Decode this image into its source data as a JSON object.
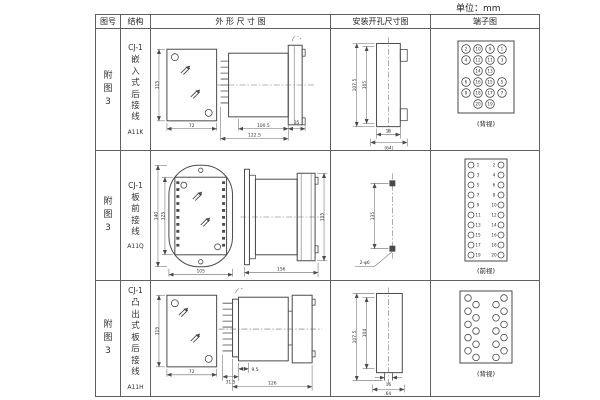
{
  "unit_label": "单位：mm",
  "colors": {
    "background": "#ffffff",
    "line": "#4a4a4a",
    "text": "#333333"
  },
  "header": {
    "figure": "图号",
    "structure": "结构",
    "outline": "外 形 尺 寸 图",
    "mounting": "安装开孔尺寸图",
    "terminal": "端子图"
  },
  "rows": [
    {
      "figure": "附图3",
      "model": "CJ-1",
      "structure": "嵌入式后接线",
      "code": "A11K",
      "outline": {
        "front_h": "115",
        "front_w": "72",
        "d1": "100.5",
        "d2": "122.5",
        "d3": "35"
      },
      "mounting": {
        "h1": "107.5",
        "h2": "105",
        "w1": "16",
        "w2": "(64)"
      },
      "terminal": {
        "view": "(背视)",
        "numbers": [
          [
            "2",
            "10",
            "9",
            "1"
          ],
          [
            "4",
            "12",
            "11",
            "3"
          ],
          [
            "14",
            "13"
          ],
          [
            "6",
            "16",
            "15",
            "5"
          ],
          [
            "8",
            "18",
            "17",
            "7"
          ],
          [
            "20",
            "19"
          ]
        ]
      }
    },
    {
      "figure": "附图3",
      "model": "CJ-1",
      "structure": "板前接线",
      "code": "A11Q",
      "outline": {
        "front_h1": "140",
        "front_h2": "125",
        "front_w": "105",
        "d1": "156",
        "d2": "115"
      },
      "mounting": {
        "h1": "135",
        "holes": "2-φ6"
      },
      "terminal": {
        "view": "(前视)",
        "left": [
          "1",
          "3",
          "5",
          "7",
          "9",
          "11",
          "13",
          "15",
          "17",
          "19"
        ],
        "right": [
          "2",
          "4",
          "6",
          "8",
          "10",
          "12",
          "14",
          "16",
          "18",
          "20"
        ]
      }
    },
    {
      "figure": "附图3",
      "model": "CJ-1",
      "structure": "凸出式板后接线",
      "code": "A11H",
      "outline": {
        "front_h": "115",
        "front_w": "72",
        "d1": "9.5",
        "d2": "31.5",
        "d3": "126"
      },
      "mounting": {
        "h1": "107.5",
        "h2": "104",
        "w1": "16",
        "w2": "64"
      },
      "terminal": {
        "view": "(背视)"
      }
    }
  ]
}
